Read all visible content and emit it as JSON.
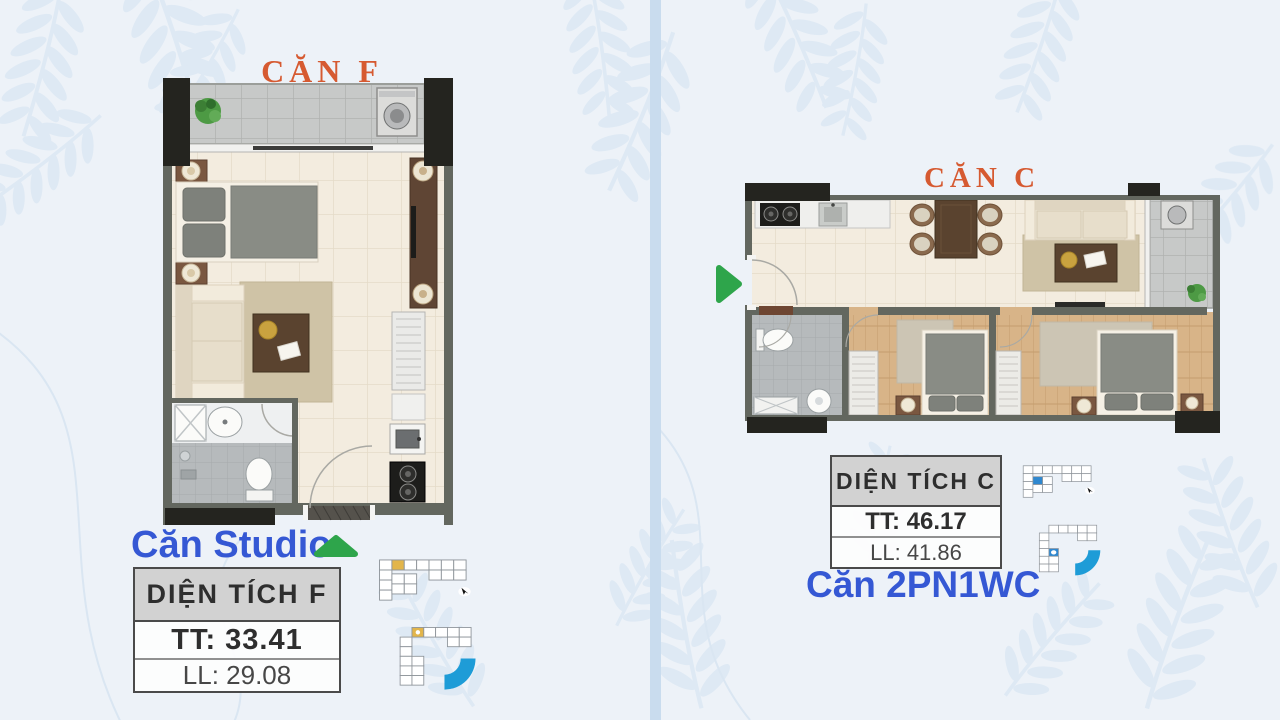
{
  "poster": {
    "description_visible_text_only": true
  },
  "colors": {
    "background": "#edf2f8",
    "leaf": "#d9e6f3",
    "divider": "#c9dcee",
    "title_orange": "#d65a31",
    "label_blue": "#3558d4",
    "arrow_green": "#2ea54b",
    "keyplan_highlight_yellow": "#e2b54b",
    "keyplan_highlight_blue": "#2f88d0",
    "keyplan_curve_blue": "#1e9cd7",
    "table_border": "#4a4a4a",
    "table_header_bg": "#d2d2d2",
    "table_text": "#2e2e2e",
    "wall_gray": "#63675f",
    "wall_black": "#24241f",
    "floor_cream": "#f3ecdf",
    "tile_gray": "#c7c9c8",
    "wood_dark": "#5a432f",
    "wood_floor": "#d8b488"
  },
  "left_unit": {
    "title": "CĂN F",
    "type_label": "Căn Studio",
    "pointer_icon": "green-up-arrow",
    "table": {
      "header": "DIỆN TÍCH F",
      "rows": [
        {
          "label": "TT",
          "value": "33.41",
          "text": "TT: 33.41"
        },
        {
          "label": "LL",
          "value": "29.08",
          "text": "LL: 29.08"
        }
      ]
    }
  },
  "right_unit": {
    "title": "CĂN C",
    "type_label": "Căn 2PN1WC",
    "pointer_icon": "green-right-arrow",
    "table": {
      "header": "DIỆN TÍCH C",
      "rows": [
        {
          "label": "TT",
          "value": "46.17",
          "text": "TT: 46.17"
        },
        {
          "label": "LL",
          "value": "41.86",
          "text": "LL: 41.86"
        }
      ]
    }
  }
}
